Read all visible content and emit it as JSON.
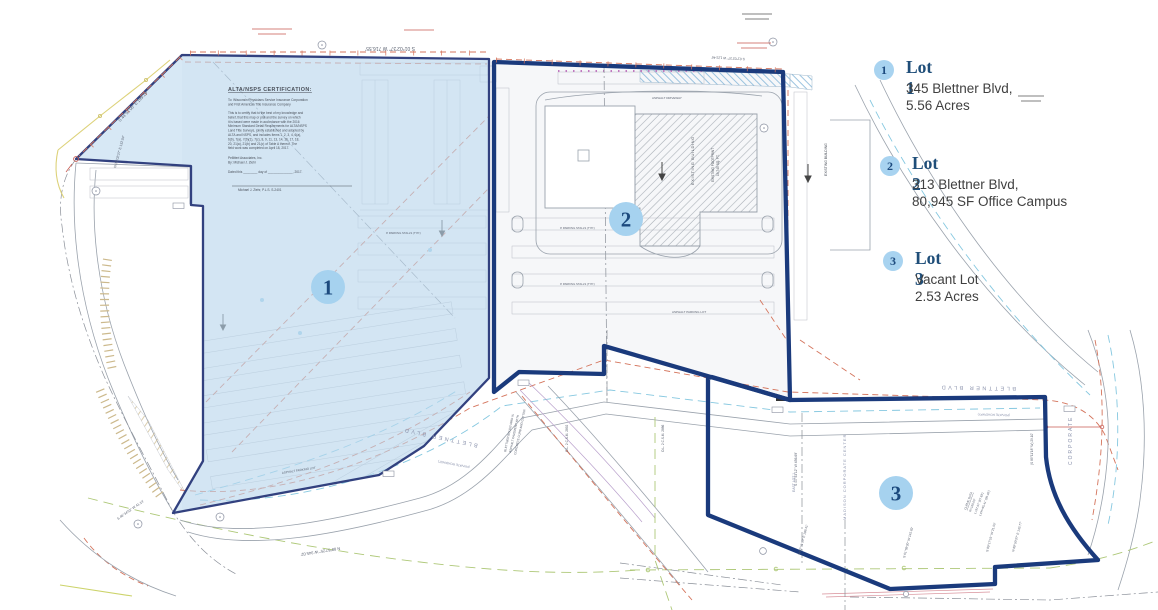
{
  "theme": {
    "navy_outline": "#1a3a7c",
    "lot1_outline": "#32417f",
    "lot1_fill": "#bcd8ee",
    "marker_fill": "#a6d2ef",
    "marker_text": "#1c4a7e",
    "legend_accent": "#1f4e79",
    "legend_body": "#404040",
    "badge_fill": "#a8d3f0",
    "red_line": "#d4745c",
    "cyan_line": "#86c8e0",
    "green_line": "#aec878",
    "tan_line": "#c9b588",
    "gray_line": "#9aa2ac",
    "purple_line": "#b9a0cc"
  },
  "legend": {
    "items": [
      {
        "number": "1",
        "title": "Lot 1",
        "line1": "345 Blettner Blvd,",
        "line2": "5.56 Acres"
      },
      {
        "number": "2",
        "title": "Lot 2",
        "line1": "313 Blettner Blvd,",
        "line2": "80,945 SF Office Campus"
      },
      {
        "number": "3",
        "title": "Lot 3",
        "line1": "Vacant Lot",
        "line2": "2.53 Acres"
      }
    ]
  },
  "markers": [
    {
      "label": "1"
    },
    {
      "label": "2"
    },
    {
      "label": "3"
    }
  ],
  "cert": {
    "title": "ALTA/NSPS CERTIFICATION:",
    "to": [
      "To: Wisconsin Physicians Service Insurance Corporation",
      "and First American Title Insurance Company"
    ],
    "body": [
      "This is to certify that to the best of my knowledge and",
      "belief, that this map or plat and the survey on which",
      "it is based were made in accordance with the 2016",
      "Minimum Standard Detail Requirements for ALTA/NSPS",
      "Land Title Surveys, jointly established and adopted by",
      "ALTA and NSPS, and includes Items 1, 2, 3, 4, 6(a),",
      "6(b), 7(a), 7(b)(1), 7(c), 8, 9, 11, 13, 14, 16, 17, 18,",
      "20, 21(a), 21(b) and 21(c) of Table A thereof. The",
      "field work was completed on April 18, 2017."
    ],
    "firm": "Pellitteri Associates, Inc.",
    "by": "By: Michael J. Ziehr",
    "dated": "Dated this ________ day of ______________, 2017.",
    "signature": "Michael J. Ziehr, P.L.S.  S-2401"
  },
  "map_labels": {
    "existing_building": "EXISTING BUILDING",
    "existing_footprint": "EXISTING FOOTPRINT",
    "footprint_area": "19,745 SQ. FT.",
    "blettner_blvd": "BLETTNER  BLVD",
    "private_roadway": "(PRIVATE ROADWAY)",
    "corporate": "CORPORATE",
    "madison_cc": "MADISON CORPORATE CENTER",
    "east_lot": "EAST LOT 1",
    "ol2_a": "O.L. 2  C.S.M. 2892",
    "ol2_b": "O.L. 2  C.S.M. 2886",
    "blettner_note_1": "BLETTNER BOULEVARD IS",
    "blettner_note_2": "ASPHALT PAVEMENT WITH",
    "blettner_note_3": "CONCRETE CURB AND GUTTER",
    "asphalt_driveway": "ASPHALT DRIVEWAY",
    "asphalt_parking": "ASPHALT PARKING LOT",
    "stalls": "9' PARKING STALLS (TYP.)",
    "curve_1": "CURVE DATA",
    "curve_2": "R=160.00'",
    "curve_3": "L=97.57'  (97.63')",
    "curve_4": "LCH=95.41'  (95.46')",
    "brg_top_1": "S 01°02'37\" W  716.55'",
    "brg_top_2": "S 01°02'37\" W  123.46'",
    "brg_nw": "S 44°51'06\" E  199.19'",
    "brg_west": "N 01°02'37\" E  132.04'",
    "brg_bottom": "N 88°57'25\" W  345.02'",
    "brg_east": "S 00°53'12\" W  456.69'",
    "brg_sw": "S 46°34'52\" W  41.14'",
    "brg_b1": "N 02°51'30\" E  188.41'",
    "brg_b2": "S 01°09'20\" W  145.82'",
    "brg_b3": "S 89°17'51\" W  21.55'",
    "brg_b4": "N 89°50'37\" E  142.77'",
    "brg_ne": "(S 89°11'18\" W)  29.10'"
  }
}
